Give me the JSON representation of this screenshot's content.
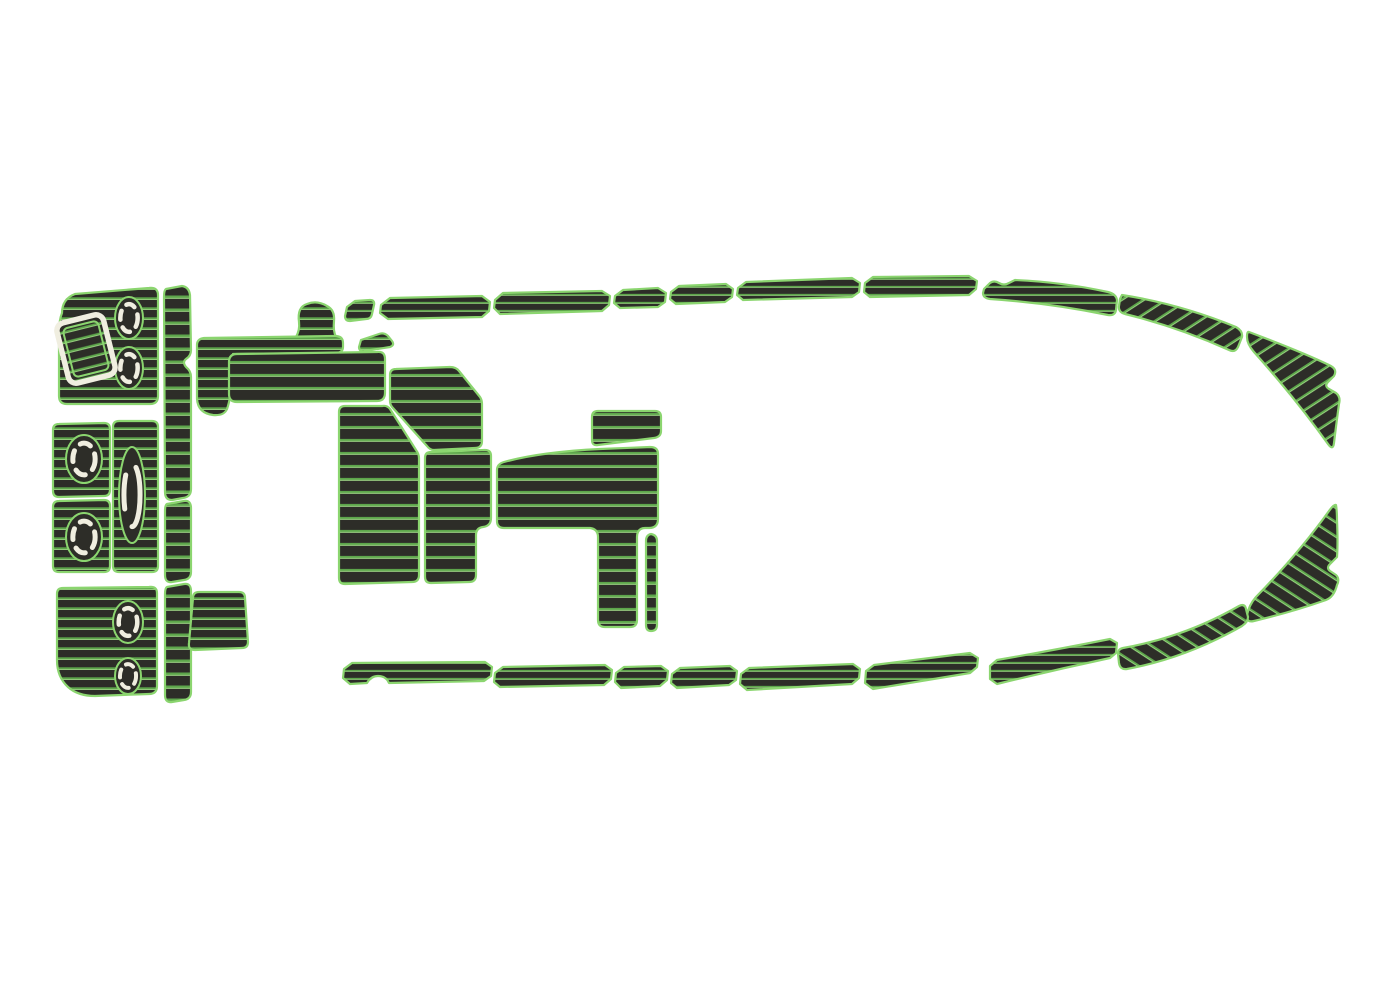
{
  "canvas": {
    "width": 1380,
    "height": 1000,
    "background": "#ffffff"
  },
  "colors": {
    "background": "#ffffff",
    "pad": "#2d2d28",
    "outline": "#8bd56f",
    "stripe": "#5da54b",
    "stripe_hi": "#a9e68f",
    "cream": "#f0eee0"
  },
  "diagram": {
    "subject": "boat-eva-foam-deck-pad-set",
    "style": "faux-teak-pads-dark-with-green-seams"
  },
  "window": {
    "name": "transom-window-cutout",
    "cx": 86,
    "cy": 349,
    "rotate": -14,
    "outer": {
      "x": -24,
      "y": -31,
      "w": 48,
      "h": 62,
      "rx": 8
    },
    "inner": {
      "x": -18,
      "y": -25,
      "w": 36,
      "h": 50,
      "rx": 5
    }
  },
  "hatches": [
    {
      "name": "transom-hatch-1",
      "cx": 129,
      "cy": 318,
      "rx": 14,
      "ry": 21,
      "rw": 4.5,
      "dash": "9 8"
    },
    {
      "name": "transom-hatch-2",
      "cx": 129,
      "cy": 368,
      "rx": 14,
      "ry": 21,
      "rw": 4.5,
      "dash": "9 8"
    },
    {
      "name": "mid-hatch-1",
      "cx": 84,
      "cy": 459,
      "rx": 18,
      "ry": 24,
      "rw": 5,
      "dash": "11 9"
    },
    {
      "name": "mid-hatch-2",
      "cx": 84,
      "cy": 537,
      "rx": 18,
      "ry": 24,
      "rw": 5,
      "dash": "11 9"
    },
    {
      "name": "mid-hatch-tall",
      "cx": 132,
      "cy": 495,
      "rx": 13,
      "ry": 48,
      "rw": 5,
      "dash": "34 20"
    },
    {
      "name": "stern-hatch-1",
      "cx": 128,
      "cy": 622,
      "rx": 15,
      "ry": 21,
      "rw": 4.5,
      "dash": "9 8"
    },
    {
      "name": "stern-hatch-2",
      "cx": 128,
      "cy": 676,
      "rx": 13,
      "ry": 18,
      "rw": 4,
      "dash": "8 7"
    }
  ],
  "pieces": [
    {
      "name": "transom-pad-top",
      "fill": "h10",
      "d": "M62,313 Q62,299 75,294 L149,288 Q158,287 158,295 L158,396 Q158,404 150,404 L67,404 Q59,404 59,396 L59,333 Q59,320 62,313 Z"
    },
    {
      "name": "transom-ladder-upper",
      "fill": "rung",
      "d": "M166,289 L182,286 Q189,287 190,295 L191,350 Q191,356 186,359 Q182,362 186,367 Q191,371 191,377 L191,489 Q191,497 183,498 L172,500 Q165,500 165,492 L164,297 Q164,290 166,289 Z"
    },
    {
      "name": "transom-ladder-middle",
      "fill": "rung",
      "d": "M167,504 L184,501 Q191,500 191,508 L191,572 Q191,579 184,580 L172,582 Q165,583 165,575 L165,511 Q165,505 167,504 Z"
    },
    {
      "name": "transom-ladder-lower",
      "fill": "rung",
      "d": "M167,587 L184,584 Q191,583 191,591 L191,692 Q191,699 184,700 L172,702 Q165,703 165,695 L165,594 Q165,588 167,587 Z"
    },
    {
      "name": "mid-pad-upper",
      "fill": "h10",
      "d": "M59,424 Q53,424 53,430 L53,491 Q53,497 59,497 L104,496 Q110,496 110,490 L110,429 Q110,423 104,423 Z"
    },
    {
      "name": "mid-pad-lower",
      "fill": "h10",
      "d": "M59,501 Q53,501 53,507 L53,566 Q53,572 59,572 L104,572 Q110,572 110,566 L110,506 Q110,500 104,500 Z"
    },
    {
      "name": "mid-pad-center",
      "fill": "h10",
      "d": "M119,421 Q113,421 113,427 L113,566 Q113,572 119,572 L152,572 Q158,572 158,566 L158,427 Q158,421 152,421 Z"
    },
    {
      "name": "transom-pad-bottom",
      "fill": "h10",
      "d": "M63,588 Q57,588 57,594 L57,660 Q57,677 68,687 Q78,696 95,696 L149,694 Q157,694 157,686 L157,593 Q157,586 149,587 Z"
    },
    {
      "name": "stern-step-pad",
      "fill": "h10",
      "d": "M199,592 Q193,592 193,598 L189,643 Q188,650 195,650 L242,648 Q248,648 248,642 L245,598 Q245,592 239,592 Z"
    },
    {
      "name": "helm-step",
      "fill": "h10",
      "d": "M301,343 Q294,343 296,337 Q300,330 299,322 Q297,307 307,304 Q317,300 327,306 Q335,310 334,321 Q333,331 336,337 Q339,343 332,343 Z"
    },
    {
      "name": "cockpit-trim",
      "fill": "h10",
      "d": "M204,338 L335,336 Q343,336 343,343 L343,347 Q343,353 335,353 L233,354 Q233,392 227,409 Q224,416 213,415 Q198,413 197,399 L197,345 Q197,339 204,338 Z"
    },
    {
      "name": "cockpit-pad-long",
      "fill": "h13",
      "d": "M237,354 Q229,354 229,362 L229,394 Q229,402 237,402 L377,401 Q385,401 385,393 L385,359 Q385,351 377,352 Z"
    },
    {
      "name": "cockpit-sliver",
      "fill": "h10",
      "d": "M361,340 L379,334 Q384,332 388,336 L392,341 Q395,345 390,347 L365,351 Q359,352 359,347 Z"
    },
    {
      "name": "cockpit-step-pad",
      "fill": "h13",
      "d": "M396,369 L450,367 Q456,367 459,371 L480,397 Q482,400 482,404 L482,441 Q482,448 475,448 L434,450 Q430,450 427,446 L393,408 Q390,405 390,401 L390,375 Q390,369 396,369 Z"
    },
    {
      "name": "cockpit-floor-left",
      "fill": "h13",
      "d": "M345,406 Q339,406 339,412 L339,578 Q339,584 345,584 L412,582 Q419,582 419,575 L419,458 Q419,454 416,450 L390,409 Q387,405 382,406 Z"
    },
    {
      "name": "cockpit-floor-right",
      "fill": "h13",
      "d": "M431,452 Q425,452 425,458 L425,577 Q425,583 431,583 L469,582 Q476,582 476,575 L476,535 Q476,528 483,527 Q491,526 491,518 L491,456 Q491,450 485,450 Z"
    },
    {
      "name": "cockpit-quad-pad",
      "fill": "h13",
      "d": "M598,411 Q592,411 592,417 L592,440 Q592,446 598,445 L654,438 Q661,437 661,431 L661,417 Q661,411 655,411 Z"
    },
    {
      "name": "cockpit-pad-main",
      "fill": "h13",
      "d": "M504,462 Q540,452 600,449 L650,447 Q658,447 658,454 L658,519 Q658,528 649,528 L645,528 Q640,528 638,532 Q637,534 637,537 L637,620 Q637,627 630,627 L605,627 Q598,627 598,620 L598,537 Q598,529 590,528 L504,528 Q497,528 497,521 L497,470 Q497,464 504,462 Z"
    },
    {
      "name": "cockpit-strip",
      "fill": "rung",
      "d": "M651,534 Q646,535 646,541 L646,625 Q646,631 651,631 Q657,631 657,625 L657,541 Q657,535 651,534 Z"
    },
    {
      "name": "gunwale-top-0",
      "fill": "h8",
      "d": "M347,307 L355,301 L370,300 Q375,300 374,305 L372,314 Q371,319 366,319 L350,321 Q345,321 345,316 Z"
    },
    {
      "name": "gunwale-top-1",
      "fill": "h8",
      "d": "M381,305 L390,298 L482,296 L490,302 L489,311 L482,317 L388,319 L380,313 Z"
    },
    {
      "name": "gunwale-top-2",
      "fill": "h8",
      "d": "M495,300 L503,293 L602,291 L610,296 L609,305 L602,311 L500,314 L494,308 Z"
    },
    {
      "name": "gunwale-top-3",
      "fill": "h8",
      "d": "M615,296 L623,290 L658,288 L666,293 L665,302 L658,307 L620,308 L614,303 Z"
    },
    {
      "name": "gunwale-top-4",
      "fill": "h8",
      "d": "M671,292 L679,286 L726,284 L733,289 L732,297 L725,302 L676,304 L670,299 Z"
    },
    {
      "name": "gunwale-top-5",
      "fill": "h8",
      "d": "M738,288 L746,282 L852,278 L860,283 L859,292 L852,297 L743,300 L737,295 Z"
    },
    {
      "name": "gunwale-top-6",
      "fill": "h8",
      "d": "M865,283 L873,277 L969,276 L977,281 L976,289 L969,295 L870,297 L864,292 Z"
    },
    {
      "name": "gunwale-top-7",
      "fill": "h8",
      "d": "M984,289 L990,283 Q994,280 999,283 Q1004,286 1009,283 L1015,280 Q1062,282 1108,292 Q1116,294 1117,300 L1116,310 Q1115,316 1108,315 Q1050,303 990,299 Q983,298 983,293 Z"
    },
    {
      "name": "gunwale-top-curve",
      "fill": "dTop",
      "d": "M1122,295 Q1180,304 1236,327 Q1243,331 1242,337 L1238,347 Q1235,353 1229,350 Q1178,327 1125,314 Q1118,312 1119,306 L1120,299 Z"
    },
    {
      "name": "gunwale-bow-top",
      "fill": "dTop",
      "d": "M1249,332 Q1302,352 1329,365 Q1338,369 1334,376 L1328,382 Q1324,386 1329,389 L1336,393 Q1341,397 1339,404 Q1336,426 1334,443 Q1333,451 1328,444 Q1296,399 1254,352 Q1247,344 1247,337 Q1247,331 1249,332 Z"
    },
    {
      "name": "gunwale-bow-bottom",
      "fill": "dBottom",
      "d": "M1336,505 Q1337,511 1337,520 Q1338,543 1337,557 L1330,564 Q1326,568 1330,571 L1336,575 Q1340,579 1337,585 Q1334,597 1326,600 Q1292,612 1254,621 Q1246,623 1247,615 Q1249,605 1256,597 Q1299,553 1329,511 Q1334,504 1336,505 Z"
    },
    {
      "name": "gunwale-bottom-curve",
      "fill": "dBottom",
      "d": "M1123,648 Q1185,637 1239,606 Q1245,603 1246,609 L1248,617 Q1248,622 1242,626 Q1186,658 1127,669 Q1120,670 1119,663 L1118,654 Q1118,649 1123,648 Z"
    },
    {
      "name": "gunwale-bottom-7",
      "fill": "h8",
      "d": "M990,666 L997,660 Q1055,650 1110,639 L1117,643 L1116,653 L1110,658 Q1054,670 997,684 L990,679 Z"
    },
    {
      "name": "gunwale-bottom-6",
      "fill": "h8",
      "d": "M866,671 L874,665 L970,653 L978,658 L977,667 L970,673 L873,689 L865,683 Z"
    },
    {
      "name": "gunwale-bottom-5",
      "fill": "h8",
      "d": "M741,674 L749,668 L853,664 L860,669 L859,678 L852,684 L747,690 L740,684 Z"
    },
    {
      "name": "gunwale-bottom-4",
      "fill": "h8",
      "d": "M672,674 L680,668 L730,666 L737,671 L736,680 L729,685 L677,688 L671,683 Z"
    },
    {
      "name": "gunwale-bottom-3",
      "fill": "h8",
      "d": "M616,673 L624,667 L661,666 L668,671 L667,680 L660,686 L621,688 L615,682 Z"
    },
    {
      "name": "gunwale-bottom-2",
      "fill": "h8",
      "d": "M495,673 L503,667 L605,665 L612,670 L611,679 L604,685 L500,687 L494,682 Z"
    },
    {
      "name": "gunwale-bottom-1",
      "fill": "h8",
      "d": "M344,669 L352,663 L485,662 L492,667 L491,676 L484,681 L389,683 Q386,676 378,676 Q371,676 367,683 L350,684 L343,678 Z"
    }
  ]
}
